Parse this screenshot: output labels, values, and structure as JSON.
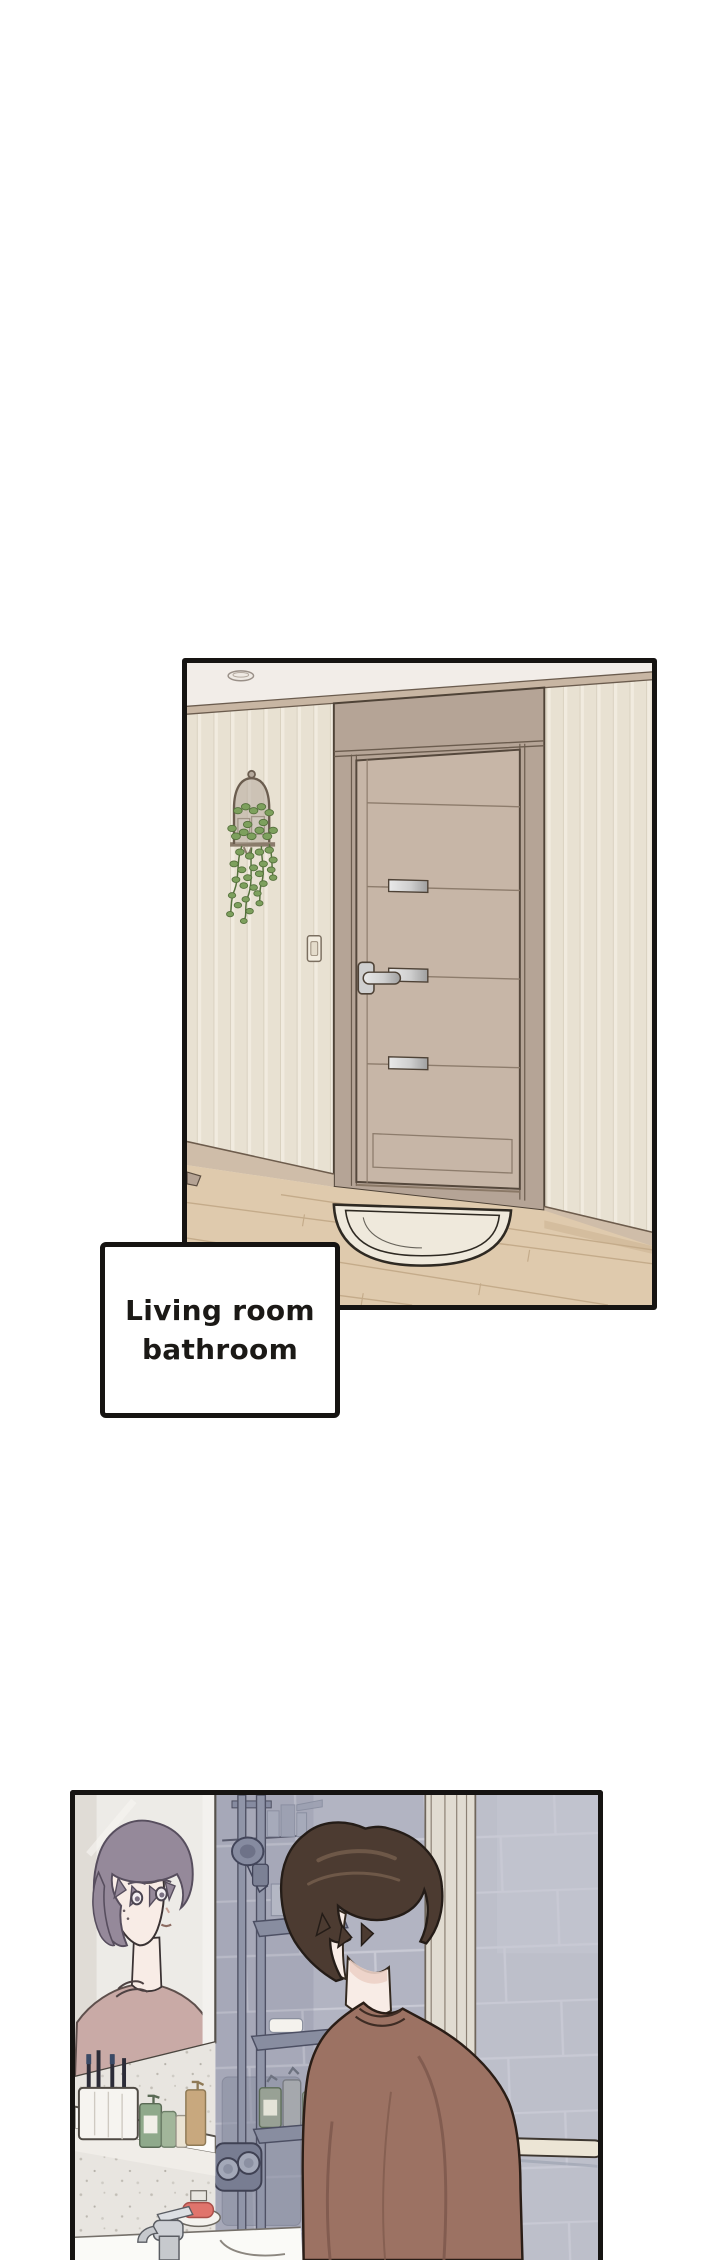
{
  "page": {
    "type": "comic-page",
    "background": "#ffffff",
    "width_px": 720,
    "height_px": 2260
  },
  "caption": {
    "line1": "Living room",
    "line2": "bathroom"
  },
  "panels": [
    {
      "name": "hallway-panel",
      "alt": "Hallway with a closed bathroom door, hanging plant in a glass cloche, light switch and a half-round door mat on a wooden floor"
    },
    {
      "name": "bathroom-panel",
      "alt": "Brown-haired man seen from behind looking at his purple-haired reflection in the bathroom mirror, blue-grey tiled shower wall with caddy shelves, sink and faucet"
    }
  ],
  "colors": {
    "paper": "#ffffff",
    "ink": "#161412",
    "ceiling": "#f2ede8",
    "trim": "#c8b6a3",
    "trim-line": "#6b5c4e",
    "wall": "#e8e1d2",
    "wall-stripe": "#f1ebdf",
    "wall-stripe-line": "#d9d1c0",
    "door-frame": "#b5a496",
    "door-frame-line": "#4f4337",
    "door": "#c7b6a7",
    "door-line": "#8d7c6c",
    "metal-hi": "#e9e9e9",
    "metal-lo": "#9f9f9f",
    "baseboard": "#cfbda9",
    "baseboard-line": "#6d5c4c",
    "floor": "#dfcaad",
    "floor-line": "#c4ab8a",
    "floor-shadow": "#d4bd9e",
    "mat": "#efe9dc",
    "mat-line": "#2e2922",
    "leaf": "#7da05d",
    "leaf-line": "#55713c",
    "planter": "#b5a99c",
    "planter-line": "#6b5d4f",
    "tile": "#b2b4c2",
    "tile-light": "#bdbfca",
    "grout": "#c8c9d4",
    "strip": "#e1dcd1",
    "strip-line": "#8b8073",
    "fixture": "#868ba0",
    "fixture-dark": "#4c4e60",
    "fixture-mid": "#9ca0b1",
    "valve": "#787d92",
    "mirror": "#edebe7",
    "mirror-frame": "#f3f1ee",
    "mirror-line": "#4a453f",
    "terrazzo": "#e8e5e0",
    "ledge": "#fbfaf8",
    "skin": "#f8ece6",
    "hair-purple": "#95899a",
    "hair-purple-line": "#574e5e",
    "shirt-mauve": "#c9aaa6",
    "shirt-mauve-line": "#5e4f4c",
    "hair-brown": "#4c3b31",
    "hair-brown-line": "#241c17",
    "hair-brown-hi": "#6e5848",
    "shirt-brown": "#9c7263",
    "shirt-brown-line": "#2a1d16",
    "shirt-brown-shade": "#7e584c",
    "green-bottle": "#8fa98b",
    "tan-bottle": "#c8a87e",
    "cream-bottle": "#eae3d3",
    "soap": "#e0746c",
    "chrome": "#c6c9cd",
    "chrome-line": "#5a5d63"
  }
}
